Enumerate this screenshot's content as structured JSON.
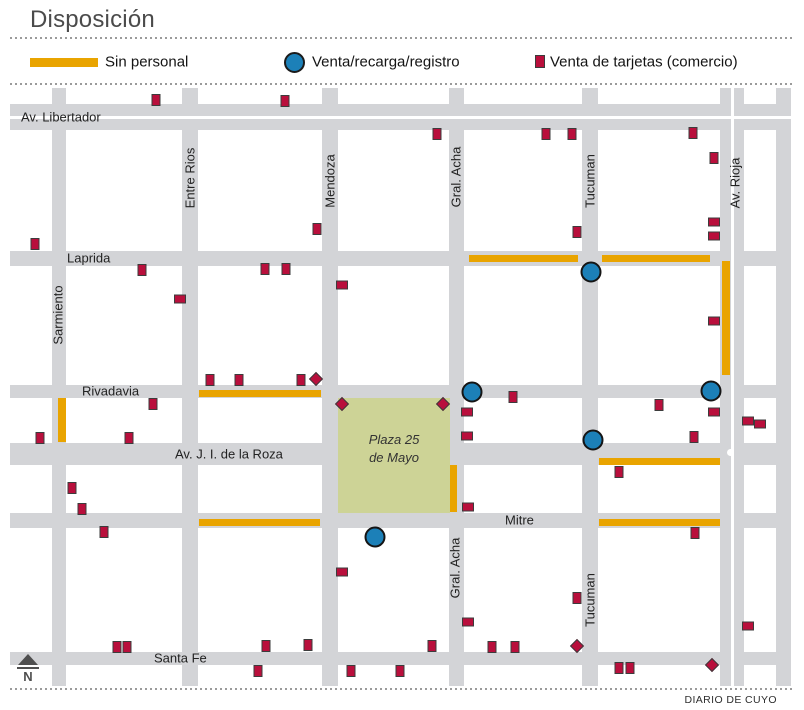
{
  "title": "Disposición",
  "credit": "DIARIO DE CUYO",
  "compass": {
    "label": "N"
  },
  "legend": {
    "items": [
      {
        "label": "Sin personal",
        "symbol": "bar",
        "color": "#E9A400"
      },
      {
        "label": "Venta/recarga/registro",
        "symbol": "circle",
        "color": "#1C80B8"
      },
      {
        "label": "Venta de tarjetas (comercio)",
        "symbol": "square",
        "color": "#B90F3C"
      }
    ]
  },
  "map": {
    "colors": {
      "street": "#D3D4D7",
      "no_staff": "#E9A400",
      "sale_point": "#1C80B8",
      "card_shop": "#B90F3C",
      "plaza": "#CDD396",
      "label": "#222222"
    },
    "extent": {
      "x0": 10,
      "x1": 791,
      "y0": 88,
      "y1": 686
    },
    "plaza": {
      "label": "Plaza 25\nde Mayo",
      "x": 338,
      "y": 398,
      "w": 112,
      "h": 115
    },
    "streets_horizontal": [
      {
        "name": "Av. Libertador",
        "y": 104,
        "h": 26,
        "divided": true,
        "labels": [
          {
            "x": 21,
            "y": 117
          }
        ]
      },
      {
        "name": "Laprida",
        "y": 251,
        "h": 15,
        "labels": [
          {
            "x": 67,
            "y": 258
          }
        ]
      },
      {
        "name": "Rivadavia",
        "y": 385,
        "h": 13,
        "labels": [
          {
            "x": 82,
            "y": 391
          }
        ]
      },
      {
        "name": "Av. J. I. de la Roza",
        "y": 443,
        "h": 22,
        "labels": [
          {
            "x": 175,
            "y": 454
          }
        ]
      },
      {
        "name": "Mitre",
        "y": 513,
        "h": 15,
        "labels": [
          {
            "x": 505,
            "y": 520
          }
        ]
      },
      {
        "name": "Santa Fe",
        "y": 652,
        "h": 13,
        "labels": [
          {
            "x": 154,
            "y": 658
          }
        ]
      }
    ],
    "streets_vertical": [
      {
        "name": "Sarmiento",
        "x": 52,
        "w": 14,
        "labels": [
          {
            "x": 58,
            "y": 315
          }
        ]
      },
      {
        "name": "Entre Rios",
        "x": 182,
        "w": 16,
        "labels": [
          {
            "x": 190,
            "y": 178
          }
        ]
      },
      {
        "name": "Mendoza",
        "x": 322,
        "w": 16,
        "labels": [
          {
            "x": 330,
            "y": 181
          }
        ]
      },
      {
        "name": "Gral. Acha",
        "x": 449,
        "w": 15,
        "labels": [
          {
            "x": 456,
            "y": 177
          },
          {
            "x": 455,
            "y": 568
          }
        ]
      },
      {
        "name": "Tucuman",
        "x": 582,
        "w": 16,
        "labels": [
          {
            "x": 590,
            "y": 181
          },
          {
            "x": 590,
            "y": 600
          }
        ]
      },
      {
        "name": "Av. Rioja",
        "x": 720,
        "w": 24,
        "divided": true,
        "labels": [
          {
            "x": 735,
            "y": 183
          }
        ]
      },
      {
        "name": "",
        "x": 776,
        "w": 15,
        "labels": []
      }
    ],
    "roundabout": {
      "x": 730,
      "y": 452,
      "d": 7
    },
    "no_staff_segments": [
      {
        "x": 469,
        "y": 255,
        "w": 109,
        "h": 7
      },
      {
        "x": 602,
        "y": 255,
        "w": 108,
        "h": 7
      },
      {
        "x": 722,
        "y": 261,
        "w": 8,
        "h": 114
      },
      {
        "x": 58,
        "y": 398,
        "w": 8,
        "h": 44
      },
      {
        "x": 199,
        "y": 390,
        "w": 122,
        "h": 7
      },
      {
        "x": 599,
        "y": 458,
        "w": 121,
        "h": 7
      },
      {
        "x": 450,
        "y": 465,
        "w": 7,
        "h": 47
      },
      {
        "x": 199,
        "y": 519,
        "w": 121,
        "h": 7
      },
      {
        "x": 599,
        "y": 519,
        "w": 121,
        "h": 7
      }
    ],
    "sale_points": [
      {
        "x": 591,
        "y": 272
      },
      {
        "x": 472,
        "y": 392
      },
      {
        "x": 711,
        "y": 391
      },
      {
        "x": 593,
        "y": 440
      },
      {
        "x": 375,
        "y": 537
      }
    ],
    "card_shops": [
      [
        156,
        100,
        "v"
      ],
      [
        285,
        101,
        "v"
      ],
      [
        437,
        134,
        "v"
      ],
      [
        546,
        134,
        "v"
      ],
      [
        572,
        134,
        "v"
      ],
      [
        693,
        133,
        "v"
      ],
      [
        714,
        158,
        "v"
      ],
      [
        35,
        244,
        "v"
      ],
      [
        142,
        270,
        "v"
      ],
      [
        265,
        269,
        "v"
      ],
      [
        286,
        269,
        "v"
      ],
      [
        317,
        229,
        "v"
      ],
      [
        714,
        222,
        "h"
      ],
      [
        714,
        236,
        "h"
      ],
      [
        577,
        232,
        "v"
      ],
      [
        342,
        285,
        "h"
      ],
      [
        180,
        299,
        "h"
      ],
      [
        714,
        321,
        "h"
      ],
      [
        210,
        380,
        "v"
      ],
      [
        239,
        380,
        "v"
      ],
      [
        301,
        380,
        "v"
      ],
      [
        316,
        379,
        "d"
      ],
      [
        342,
        404,
        "d"
      ],
      [
        443,
        404,
        "d"
      ],
      [
        153,
        404,
        "v"
      ],
      [
        513,
        397,
        "v"
      ],
      [
        467,
        412,
        "h"
      ],
      [
        467,
        436,
        "h"
      ],
      [
        659,
        405,
        "v"
      ],
      [
        714,
        412,
        "h"
      ],
      [
        748,
        421,
        "h"
      ],
      [
        760,
        424,
        "h"
      ],
      [
        40,
        438,
        "v"
      ],
      [
        129,
        438,
        "v"
      ],
      [
        694,
        437,
        "v"
      ],
      [
        72,
        488,
        "v"
      ],
      [
        619,
        472,
        "v"
      ],
      [
        82,
        509,
        "v"
      ],
      [
        468,
        507,
        "h"
      ],
      [
        104,
        532,
        "v"
      ],
      [
        695,
        533,
        "v"
      ],
      [
        342,
        572,
        "h"
      ],
      [
        577,
        598,
        "v"
      ],
      [
        468,
        622,
        "h"
      ],
      [
        748,
        626,
        "h"
      ],
      [
        432,
        646,
        "v"
      ],
      [
        117,
        647,
        "v"
      ],
      [
        127,
        647,
        "v"
      ],
      [
        266,
        646,
        "v"
      ],
      [
        308,
        645,
        "v"
      ],
      [
        492,
        647,
        "v"
      ],
      [
        515,
        647,
        "v"
      ],
      [
        577,
        646,
        "d"
      ],
      [
        258,
        671,
        "v"
      ],
      [
        351,
        671,
        "v"
      ],
      [
        400,
        671,
        "v"
      ],
      [
        619,
        668,
        "v"
      ],
      [
        630,
        668,
        "v"
      ],
      [
        712,
        665,
        "d"
      ]
    ]
  }
}
